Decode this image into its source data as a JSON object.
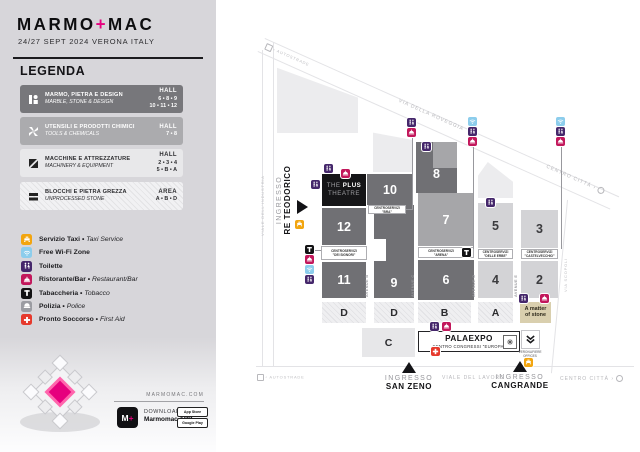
{
  "header": {
    "logo_marmo": "MARMO",
    "logo_plus": "+",
    "logo_mac": "MAC",
    "subtitle": "24/27 SEPT 2024 VERONA ITALY"
  },
  "legend": {
    "title": "LEGENDA",
    "categories": [
      {
        "title": "MARMO, PIETRA E DESIGN",
        "subtitle": "MARBLE, STONE & DESIGN",
        "unit": "HALL",
        "nums1": "6 • 8 • 9",
        "nums2": "10 • 11 • 12"
      },
      {
        "title": "UTENSILI E PRODOTTI CHIMICI",
        "subtitle": "TOOLS & CHEMICALS",
        "unit": "HALL",
        "nums1": "7 • 8",
        "nums2": ""
      },
      {
        "title": "MACCHINE E ATTREZZATURE",
        "subtitle": "MACHINERY & EQUIPMENT",
        "unit": "HALL",
        "nums1": "2 • 3 • 4",
        "nums2": "5 • B • A"
      },
      {
        "title": "BLOCCHI E PIETRA GREZZA",
        "subtitle": "UNPROCESSED STONE",
        "unit": "AREA",
        "nums1": "A • B • D",
        "nums2": ""
      }
    ],
    "services": [
      {
        "name": "taxi",
        "label": "Servizio Taxi",
        "sep": " • ",
        "en": "Taxi Service"
      },
      {
        "name": "wifi",
        "label": "Free Wi-Fi Zone",
        "sep": "",
        "en": ""
      },
      {
        "name": "toilette",
        "label": "Toilette",
        "sep": "",
        "en": ""
      },
      {
        "name": "restaurant",
        "label": "Ristorante/Bar",
        "sep": " • ",
        "en": "Restaurant/Bar"
      },
      {
        "name": "tobacco",
        "label": "Tabaccheria",
        "sep": " • ",
        "en": "Tobacco"
      },
      {
        "name": "police",
        "label": "Polizia",
        "sep": " • ",
        "en": "Police"
      },
      {
        "name": "first-aid",
        "label": "Pronto Soccorso",
        "sep": " • ",
        "en": "First Aid"
      }
    ]
  },
  "footer": {
    "website": "MARMOMAC.COM",
    "download_label": "DOWNLOAD",
    "app_label": "Marmomac APP",
    "app_icon_m": "M",
    "app_icon_plus": "+",
    "badge_appstore": "App Store",
    "badge_play": "Google Play"
  },
  "map": {
    "halls": [
      "10",
      "12",
      "11",
      "9",
      "8",
      "7",
      "6",
      "5",
      "4",
      "3",
      "2"
    ],
    "areas": [
      "D",
      "D",
      "B",
      "A",
      "C"
    ],
    "theatre": {
      "the": "THE ",
      "plus": "PLUS",
      "line2": "THEATRE"
    },
    "centroservizi": {
      "dei_signori": {
        "l1": "CENTROSERVIZI",
        "l2": "\"DEI SIGNORI\""
      },
      "bra": {
        "l1": "CENTROSERVIZI \"BRA\""
      },
      "arena": {
        "l1": "CENTROSERVIZI",
        "l2": "\"ARENA\""
      },
      "delle_erbe": {
        "l1": "CENTROSERVIZI",
        "l2": "\"DELLE ERBE\""
      },
      "castelvecchio": {
        "l1": "CENTROSERVIZI",
        "l2": "\"CASTELVECCHIO\""
      }
    },
    "palaexpo": {
      "title": "PALAEXPO",
      "subtitle": "CENTRO CONGRESSI \"EUROPA\""
    },
    "matter_of_stone": {
      "l1": "A matter",
      "l2": "of stone"
    },
    "veronafiere": {
      "l1": "VERONAFIERE",
      "l2": "OFFICES"
    },
    "entrances": {
      "prefix": "INGRESSO",
      "re_teodorico": "RE TEODORICO",
      "san_zeno": "SAN ZENO",
      "cangrande": "CANGRANDE"
    },
    "roads": {
      "autostrade_top": "AUTOSTRADE",
      "via_roveggia": "VIA DELLA ROVEGGIA",
      "centro_citta_top": "CENTRO CITTÀ",
      "viale_industria": "VIALE DELL'INDUSTRIA",
      "via_scopoli": "VIA SCOPOLI",
      "viale_lavoro": "VIALE DEL LAVORO",
      "autostrade_bottom": "AUTOSTRADE",
      "centro_citta_bottom": "CENTRO CITTÀ"
    },
    "avenues": [
      "AVENUE B",
      "AVENUE C",
      "AVENUE D",
      "AVENUE E"
    ]
  },
  "colors": {
    "accent_pink": "#e6007e",
    "taxi": "#f2a50f",
    "wifi": "#8ccdec",
    "toilette": "#45276b",
    "restaurant": "#c2175b",
    "tobacco": "#111111",
    "police": "#9b9ca2",
    "first_aid": "#e6392c",
    "hall_dark": "#707074",
    "hall_medium": "#a6a6a9",
    "hall_light": "#d3d3d6"
  }
}
